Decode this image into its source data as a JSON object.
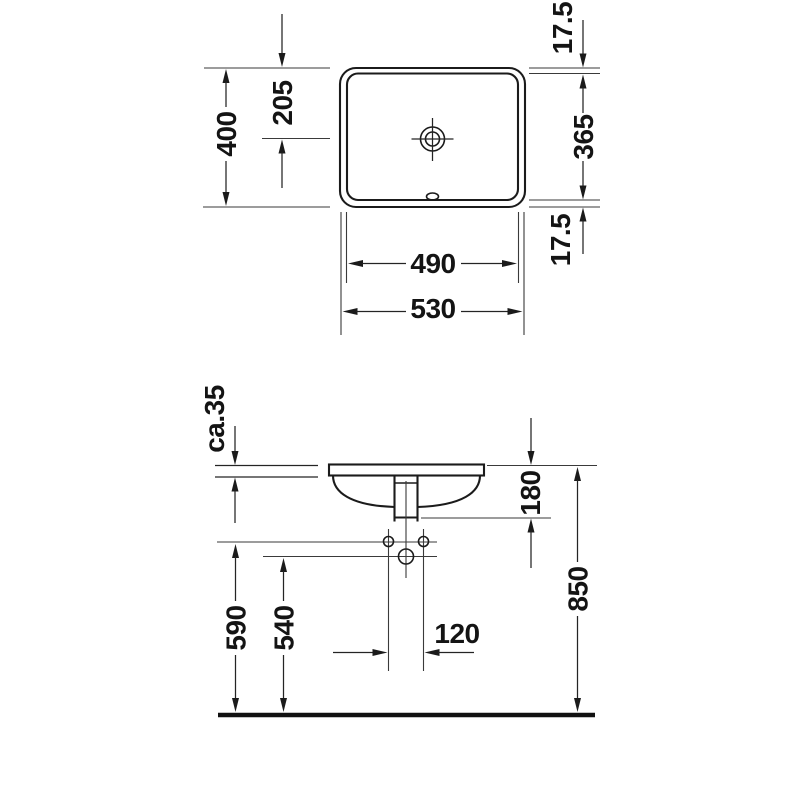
{
  "meta": {
    "drawing_type": "sanitary technical drawing",
    "background": "#ffffff",
    "line_color": "#1b1b1b"
  },
  "dimensions": {
    "top": {
      "overall_depth": "400",
      "drain_offset": "205",
      "rim_back": "17.5",
      "basin_depth": "365",
      "rim_front": "17.5",
      "basin_width": "490",
      "overall_width": "530"
    },
    "front": {
      "counter_thickness": "ca.35",
      "basin_height": "180",
      "rim_height": "850",
      "hole_line_height": "590",
      "drain_line_height": "540",
      "hole_spacing": "120"
    }
  }
}
